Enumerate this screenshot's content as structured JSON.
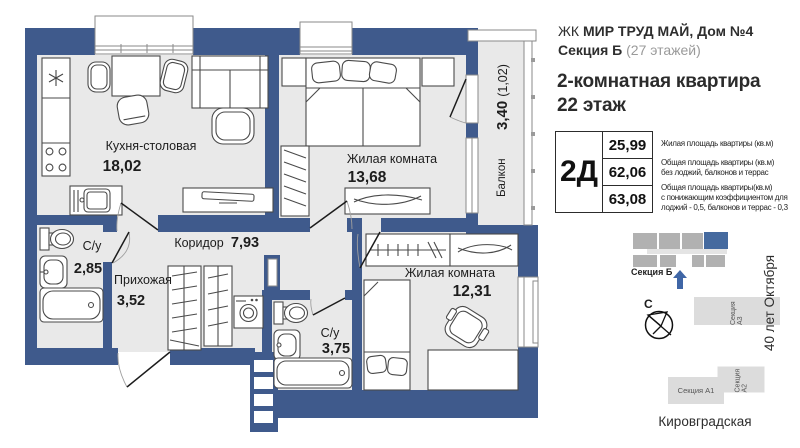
{
  "colors": {
    "wall": "#3f5a8c",
    "floor": "#e9e9e9",
    "accent_blue": "#3f66a6",
    "map_block_gray": "#b1b1b1",
    "map_block_light": "#dcdcdc"
  },
  "plan": {
    "rooms": [
      {
        "name": "Кухня-столовая",
        "area": "18,02"
      },
      {
        "name": "Жилая комната",
        "area": "13,68"
      },
      {
        "name": "Коридор",
        "area": "7,93"
      },
      {
        "name": "Прихожая",
        "area": "3,52"
      },
      {
        "name": "С/у",
        "area": "2,85"
      },
      {
        "name": "С/у",
        "area": "3,75"
      },
      {
        "name": "Жилая комната",
        "area": "12,31"
      },
      {
        "name": "Балкон",
        "area": "3,40",
        "note": "(1,02)"
      }
    ]
  },
  "header": {
    "complex_prefix": "ЖК ",
    "complex_name": "МИР ТРУД МАЙ,  Дом №4",
    "section": "Секция Б",
    "floors_note": " (27 этажей)",
    "apartment_type": "2-комнатная квартира",
    "floor": "22 этаж"
  },
  "spec_table": {
    "type_code": "2Д",
    "rows": [
      {
        "value": "25,99",
        "lines": [
          "Жилая площадь квартиры (кв.м)"
        ]
      },
      {
        "value": "62,06",
        "lines": [
          "Общая площадь квартиры (кв.м)",
          "без лоджий, балконов и террас"
        ]
      },
      {
        "value": "63,08",
        "lines": [
          "Общая площадь квартиры(кв.м)",
          "с понижающим коэффициентом для",
          "лоджий - 0,5, балконов и террас - 0,3"
        ]
      }
    ]
  },
  "site_map": {
    "current_section_label": "Секция Б",
    "compass_north": "С",
    "sections": [
      "Секция А3",
      "Секция А2",
      "Секция А1"
    ],
    "street_right": "40 лет Октября",
    "street_bottom": "Кировградская"
  }
}
